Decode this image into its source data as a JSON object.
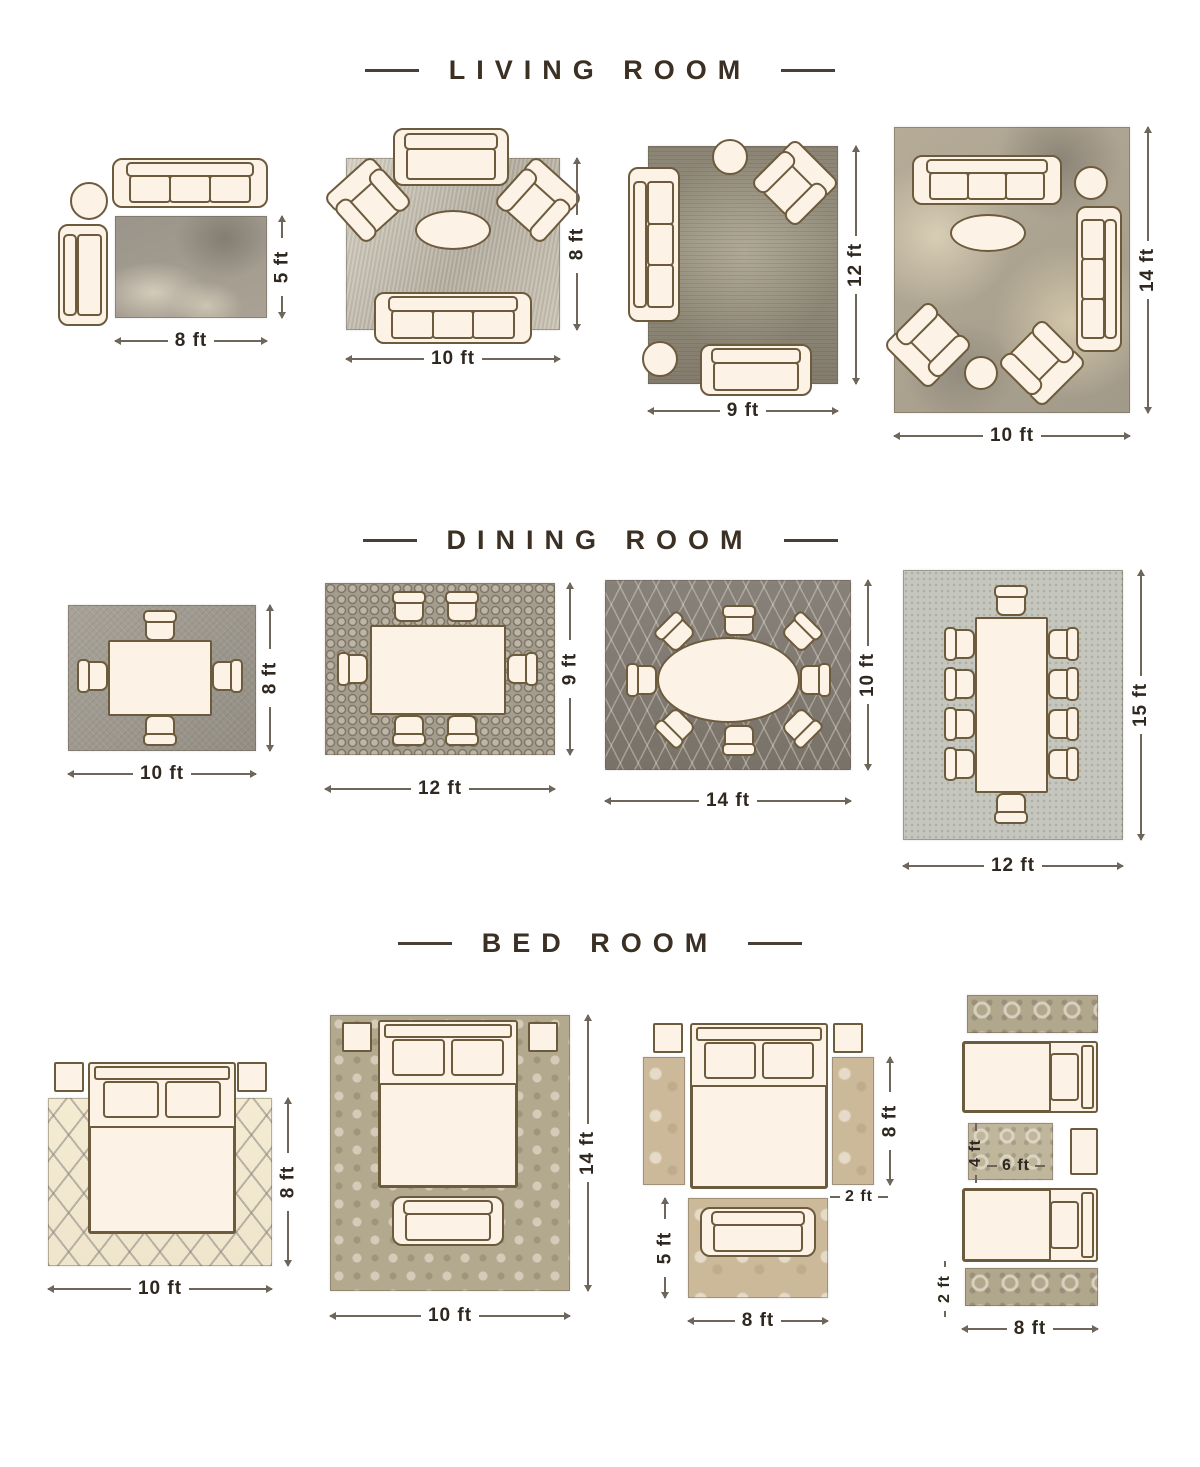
{
  "page": {
    "background": "#ffffff",
    "accent_colors": {
      "heading_text": "#3b3023",
      "dimension_text": "#2f2820",
      "dimension_line": "#6e665a",
      "furniture_fill": "#fcf3e6",
      "furniture_outline": "#6d5b3e"
    }
  },
  "sections": [
    {
      "title": "LIVING ROOM",
      "layouts": [
        {
          "dims": {
            "w": "8 ft",
            "h": "5 ft"
          }
        },
        {
          "dims": {
            "w": "10 ft",
            "h": "8 ft"
          }
        },
        {
          "dims": {
            "w": "9 ft",
            "h": "12 ft"
          }
        },
        {
          "dims": {
            "w": "10 ft",
            "h": "14 ft"
          }
        }
      ]
    },
    {
      "title": "DINING ROOM",
      "layouts": [
        {
          "dims": {
            "w": "10 ft",
            "h": "8 ft"
          }
        },
        {
          "dims": {
            "w": "12 ft",
            "h": "9 ft"
          }
        },
        {
          "dims": {
            "w": "14 ft",
            "h": "10 ft"
          }
        },
        {
          "dims": {
            "w": "12 ft",
            "h": "15 ft"
          }
        }
      ]
    },
    {
      "title": "BED ROOM",
      "layouts": [
        {
          "dims": {
            "w": "10 ft",
            "h": "8 ft"
          }
        },
        {
          "dims": {
            "w": "10 ft",
            "h": "14 ft"
          }
        },
        {
          "dims": {
            "w": "8 ft",
            "side_runner_len": "8 ft",
            "side_runner_w": "2 ft",
            "front_rug_h": "5 ft"
          }
        },
        {
          "dims": {
            "w": "8 ft",
            "center_rug_w": "6 ft",
            "center_rug_h": "4 ft",
            "runner_w": "2 ft"
          }
        }
      ]
    }
  ]
}
